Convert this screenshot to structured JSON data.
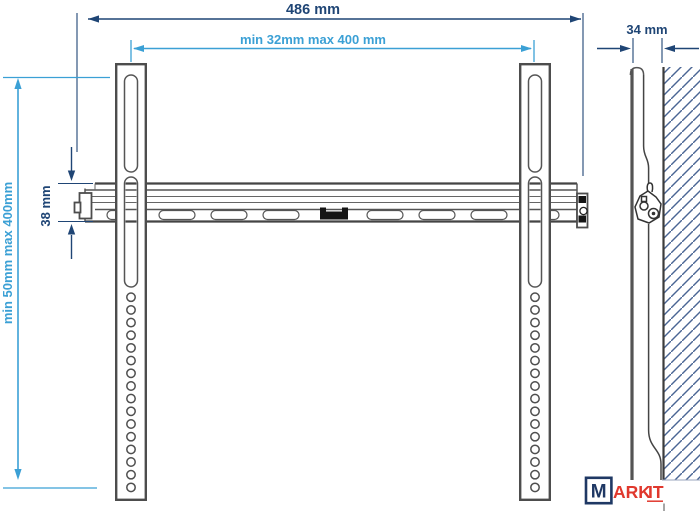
{
  "diagram": {
    "front_view": {
      "overall_width_label": "486 mm",
      "mount_width_label": "min 32mm max 400 mm",
      "rail_height_label": "38 mm",
      "mount_height_label": "min 50mm max 400mm"
    },
    "side_view": {
      "depth_label": "34 mm"
    }
  },
  "logo": {
    "prefix": "M",
    "middle": "ARK",
    "suffix": "IT"
  },
  "colors": {
    "dimension_primary": "#1f4575",
    "dimension_secondary": "#3ba0d5",
    "outline": "#4d4d4d",
    "hatch": "#4a6594",
    "logo_navy": "#1f3864",
    "logo_red": "#e0382d"
  }
}
